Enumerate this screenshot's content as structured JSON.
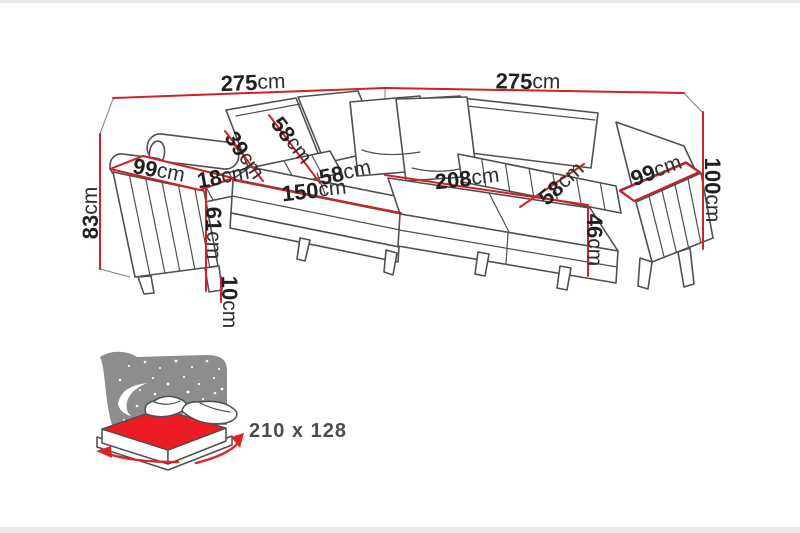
{
  "diagram": {
    "type": "corner-sofa-dimension-diagram",
    "colors": {
      "dimension_red": "#cf2127",
      "line_gray": "#4f4f4f",
      "headboard_gray": "#8d8d8f",
      "mattress_red": "#ec1c24"
    },
    "dimensions": {
      "width_left": {
        "value": "275",
        "unit": "cm"
      },
      "width_right": {
        "value": "275",
        "unit": "cm"
      },
      "height_back_left": {
        "value": "83",
        "unit": "cm"
      },
      "height_back_right": {
        "value": "100",
        "unit": "cm"
      },
      "armrest_left_depth": {
        "value": "99",
        "unit": "cm"
      },
      "armrest_left_width": {
        "value": "18",
        "unit": "cm"
      },
      "headrest_width": {
        "value": "39",
        "unit": "cm"
      },
      "backrest_cushion_width": {
        "value": "58",
        "unit": "cm"
      },
      "seat_left_length": {
        "value": "150",
        "unit": "cm"
      },
      "seat_left_cushion": {
        "value": "58",
        "unit": "cm"
      },
      "seat_right_length": {
        "value": "208",
        "unit": "cm"
      },
      "seat_right_depth": {
        "value": "58",
        "unit": "cm"
      },
      "armrest_right_depth": {
        "value": "99",
        "unit": "cm"
      },
      "seat_height": {
        "value": "61",
        "unit": "cm"
      },
      "seat_front_height": {
        "value": "46",
        "unit": "cm"
      },
      "leg_height": {
        "value": "10",
        "unit": "cm"
      }
    },
    "sleeping_area": {
      "icon": "sofa-bed-sleeping-area-icon",
      "size": "210 x 128"
    }
  }
}
